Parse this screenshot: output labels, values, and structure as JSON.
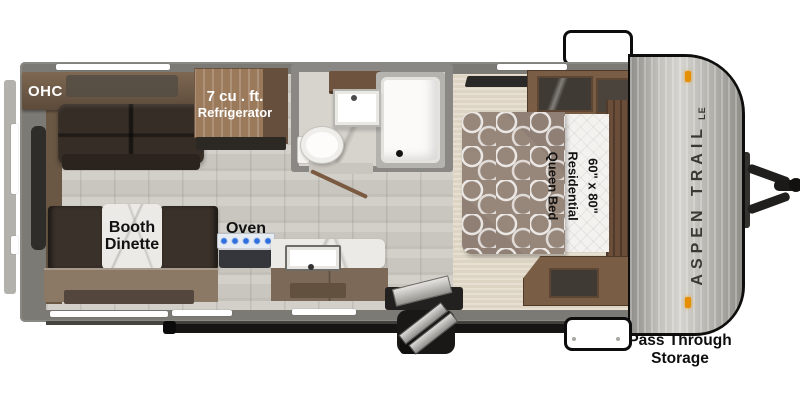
{
  "plan": {
    "title": "Aspen Trail LE travel trailer floor plan",
    "labels": {
      "ohc": "OHC",
      "refrigerator_line1": "7 cu . ft.",
      "refrigerator_line2": "Refrigerator",
      "booth_line1": "Booth",
      "booth_line2": "Dinette",
      "oven": "Oven",
      "bed_size": "60\" x 80\"",
      "bed_type": "Residential",
      "bed_name": "Queen Bed",
      "pass_through_line1": "Pass Through",
      "pass_through_line2": "Storage",
      "brand": "ASPEN TRAIL",
      "brand_edition": "LE"
    },
    "colors": {
      "wall": "#7c7a75",
      "cabinet_wood": "#7a5d45",
      "sofa_upholstery": "#362d26",
      "marble": "#eceae6",
      "carpet": "#ddd4c3",
      "cooktop_burner": "#2f6fde",
      "marker_light": "#e58f05",
      "cap_silver": "#c6c4bf"
    }
  }
}
